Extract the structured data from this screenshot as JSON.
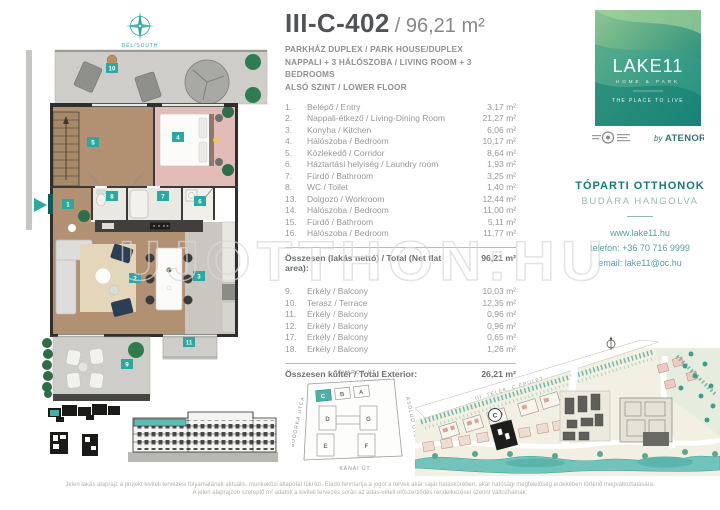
{
  "header": {
    "unit_id": "III-C-402",
    "area_display": "/ 96,21 m²",
    "subtitle_lines": [
      "PARKHÁZ DUPLEX / PARK HOUSE/DUPLEX",
      "NAPPALI + 3 HÁLÓSZOBA  / LIVING ROOM + 3 BEDROOMS",
      "ALSÓ SZINT / LOWER FLOOR"
    ]
  },
  "rooms": {
    "interior": [
      {
        "no": "1.",
        "name": "Belépő / Entry",
        "area": "3,17 m²"
      },
      {
        "no": "2.",
        "name": "Nappali-étkező / Living-Dining Room",
        "area": "21,27 m²"
      },
      {
        "no": "3.",
        "name": "Konyha / Kitchen",
        "area": "6,06 m²"
      },
      {
        "no": "4.",
        "name": "Hálószoba / Bedroom",
        "area": "10,17 m²"
      },
      {
        "no": "5.",
        "name": "Közlekedő / Corridor",
        "area": "8,64 m²"
      },
      {
        "no": "6.",
        "name": "Háztartási helyiség / Laundry room",
        "area": "1,93 m²"
      },
      {
        "no": "7.",
        "name": "Fürdő / Bathroom",
        "area": "3,25 m²"
      },
      {
        "no": "8.",
        "name": "WC / Toilet",
        "area": "1,40 m²"
      },
      {
        "no": "13.",
        "name": "Dolgozó / Workroom",
        "area": "12,44 m²"
      },
      {
        "no": "14.",
        "name": "Hálószoba / Bedroom",
        "area": "11,00 m²"
      },
      {
        "no": "15.",
        "name": "Fürdő / Bathroom",
        "area": "5,11 m²"
      },
      {
        "no": "16.",
        "name": "Hálószoba / Bedroom",
        "area": "11,77 m²"
      }
    ],
    "exterior": [
      {
        "no": "9.",
        "name": "Erkély / Balcony",
        "area": "10,03 m²"
      },
      {
        "no": "10.",
        "name": "Terasz / Terrace",
        "area": "12,35 m²"
      },
      {
        "no": "11.",
        "name": "Erkély / Balcony",
        "area": "0,96 m²"
      },
      {
        "no": "12.",
        "name": "Erkély / Balcony",
        "area": "0,96 m²"
      },
      {
        "no": "17.",
        "name": "Erkély / Balcony",
        "area": "0,65 m²"
      },
      {
        "no": "18.",
        "name": "Erkély / Balcony",
        "area": "1,26 m²"
      }
    ]
  },
  "totals": {
    "interior_label": "Összesen (lakás nettó) / Total (Net flat area):",
    "interior_value": "96,21 m²",
    "exterior_label": "Összesen kültér / Total Exterior:",
    "exterior_value": "26,21 m²"
  },
  "plan": {
    "compass_label": "DÉL/SOUTH",
    "badges": [
      "1",
      "2",
      "3",
      "4",
      "5",
      "6",
      "7",
      "8",
      "9",
      "10",
      "11"
    ]
  },
  "blockplan": {
    "streets": {
      "top": "TÓVÁROS ÚT",
      "left": "BODORKA UTCA",
      "right": "ÁSÓLÚD UTCA",
      "bottom": "KÁNAI ÚT"
    },
    "buildings": [
      "A",
      "B",
      "C",
      "D",
      "E",
      "F",
      "G"
    ]
  },
  "sitemap": {
    "road_label": "III. TELEK, C ÉPÜLET",
    "building_marker": "C"
  },
  "brand": {
    "logo_title": "LAKE11",
    "logo_subtitle": "HOME & PARK",
    "logo_tagline": "THE PLACE TO LIVE",
    "byline_prefix": "by",
    "byline_name": "ATENOR"
  },
  "contact": {
    "heading": "TÓPARTI OTTHONOK",
    "subheading": "BUDÁRA HANGOLVA",
    "website": "www.lake11.hu",
    "phone": "telefon: +36 70 716 9999",
    "email": "email: lake11@oc.hu"
  },
  "watermark": "UJOTTHON:HU",
  "disclaimer": {
    "line1": "Jelen lakás alaprajz a projekt kiviteli tervezési folyamatának aktuális, munkaközi állapotát tükrözi. Eladó fenntartja a jogot a tervek akár saját hatáskörében, akár hatósági megfelelőség érdekében történő megváltoztatására.",
    "line2": "A jelen alaprajzon szereplő m² adatok a kiviteli tervezés során az adás-vételi előszerződés rendelkezései szerint változhatnak."
  },
  "colors": {
    "accent_teal": "#2BA89F",
    "brand_teal_dark": "#0F7C77",
    "logo_green_light": "#8CC591",
    "logo_green_dark": "#0C7F74",
    "navy_chair": "#2C3E54",
    "wood_floor": "#B29172"
  }
}
